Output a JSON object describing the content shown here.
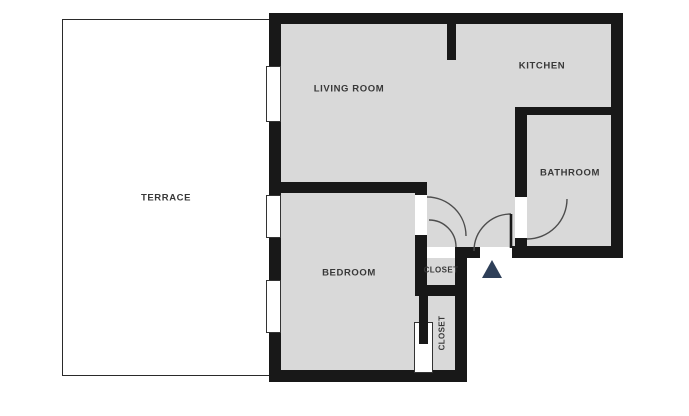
{
  "plan": {
    "title": "apartment-floor-plan",
    "rooms": [
      {
        "id": "terrace",
        "label": "TERRACE"
      },
      {
        "id": "living-room",
        "label": "LIVING ROOM"
      },
      {
        "id": "kitchen",
        "label": "KITCHEN"
      },
      {
        "id": "bathroom",
        "label": "BATHROOM"
      },
      {
        "id": "bedroom",
        "label": "BEDROOM"
      },
      {
        "id": "closet-top",
        "label": "CLOSET"
      },
      {
        "id": "closet-bottom",
        "label": "CLOSET"
      }
    ],
    "markers": [
      {
        "id": "entrance-triangle",
        "shape": "triangle-up",
        "color": "#2e3f58"
      }
    ],
    "features": {
      "windows": [
        "living-room-window",
        "bedroom-window-upper",
        "bedroom-window-lower"
      ],
      "doors": [
        "bedroom-door",
        "closet-door",
        "entry-door",
        "bathroom-door",
        "closet-sliding-door"
      ]
    },
    "colors": {
      "floor": "#d9d9d9",
      "wall": "#181818",
      "terrace_floor": "#ffffff",
      "door_arc": "#4d4d4d",
      "label_text": "#383838",
      "entrance_marker": "#2e3f58"
    }
  }
}
